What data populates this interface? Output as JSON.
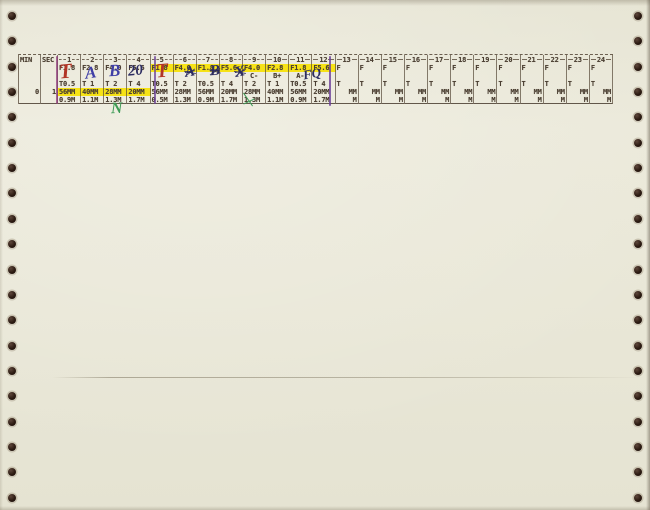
{
  "colors": {
    "paper": "#e9e7d7",
    "ink": "#4a3e31",
    "highlight_yellow": "#f6e216",
    "red_pen": "#b23527",
    "blue_pen": "#3f3fa6",
    "dark_blue_pen": "#2c2c60",
    "green_pen": "#3d9b55",
    "purple_marker": "#6a3f97"
  },
  "table": {
    "min_header": "MIN",
    "sec_header": "SEC",
    "min_value": "0",
    "sec_value": "1",
    "f_highlight_cols": [
      5,
      6,
      7,
      8,
      9,
      10,
      11,
      12
    ],
    "mm_highlight_cols": [
      1,
      2,
      3,
      4
    ],
    "columns": [
      {
        "num": "1",
        "f": "F1.8",
        "grade": "",
        "t": "T0.5",
        "mm": "56MM",
        "m": "0.9M"
      },
      {
        "num": "2",
        "f": "F2.8",
        "grade": "",
        "t": "T 1",
        "mm": "40MM",
        "m": "1.1M"
      },
      {
        "num": "3",
        "f": "F4.0",
        "grade": "",
        "t": "T 2",
        "mm": "28MM",
        "m": "1.3M"
      },
      {
        "num": "4",
        "f": "F5.6",
        "grade": "",
        "t": "T 4",
        "mm": "20MM",
        "m": "1.7M"
      },
      {
        "num": "5",
        "f": "F1.8",
        "grade": "",
        "t": "T0.5",
        "mm": "56MM",
        "m": "0.5M"
      },
      {
        "num": "6",
        "f": "F4.0",
        "grade": "",
        "t": "T 2",
        "mm": "28MM",
        "m": "1.3M"
      },
      {
        "num": "7",
        "f": "F1.8",
        "grade": "",
        "t": "T0.5",
        "mm": "56MM",
        "m": "0.9M"
      },
      {
        "num": "8",
        "f": "F5.6",
        "grade": "",
        "t": "T 4",
        "mm": "20MM",
        "m": "1.7M"
      },
      {
        "num": "9",
        "f": "F4.0",
        "grade": "C-",
        "t": "T 2",
        "mm": "28MM",
        "m": "1.3M"
      },
      {
        "num": "10",
        "f": "F2.8",
        "grade": "B+",
        "t": "T 1",
        "mm": "40MM",
        "m": "1.1M"
      },
      {
        "num": "11",
        "f": "F1.8",
        "grade": "A-",
        "t": "T0.5",
        "mm": "56MM",
        "m": "0.9M"
      },
      {
        "num": "12",
        "f": "F5.6",
        "grade": "",
        "t": "T 4",
        "mm": "20MM",
        "m": "1.7M"
      },
      {
        "num": "13",
        "f": "F",
        "grade": "",
        "t": "T",
        "mm": "MM",
        "m": "M"
      },
      {
        "num": "14",
        "f": "F",
        "grade": "",
        "t": "T",
        "mm": "MM",
        "m": "M"
      },
      {
        "num": "15",
        "f": "F",
        "grade": "",
        "t": "T",
        "mm": "MM",
        "m": "M"
      },
      {
        "num": "16",
        "f": "F",
        "grade": "",
        "t": "T",
        "mm": "MM",
        "m": "M"
      },
      {
        "num": "17",
        "f": "F",
        "grade": "",
        "t": "T",
        "mm": "MM",
        "m": "M"
      },
      {
        "num": "18",
        "f": "F",
        "grade": "",
        "t": "T",
        "mm": "MM",
        "m": "M"
      },
      {
        "num": "19",
        "f": "F",
        "grade": "",
        "t": "T",
        "mm": "MM",
        "m": "M"
      },
      {
        "num": "20",
        "f": "F",
        "grade": "",
        "t": "T",
        "mm": "MM",
        "m": "M"
      },
      {
        "num": "21",
        "f": "F",
        "grade": "",
        "t": "T",
        "mm": "MM",
        "m": "M"
      },
      {
        "num": "22",
        "f": "F",
        "grade": "",
        "t": "T",
        "mm": "MM",
        "m": "M"
      },
      {
        "num": "23",
        "f": "F",
        "grade": "",
        "t": "T",
        "mm": "MM",
        "m": "M"
      },
      {
        "num": "24",
        "f": "F",
        "grade": "",
        "t": "T",
        "mm": "MM",
        "m": "M"
      }
    ]
  },
  "annotations": [
    {
      "id": "hw-grade-col1",
      "text": "T",
      "color": "#b23527"
    },
    {
      "id": "hw-grade-col2",
      "text": "A",
      "color": "#3f3fa6"
    },
    {
      "id": "hw-grade-col3",
      "text": "B",
      "color": "#3f3fa6"
    },
    {
      "id": "hw-grade-col4",
      "text": "20",
      "color": "#2c2c60"
    },
    {
      "id": "hw-grade-col5",
      "text": "T",
      "color": "#b23527"
    },
    {
      "id": "hw-scribble-col6",
      "text": "A",
      "color": "#2c2c60"
    },
    {
      "id": "hw-scribble-col7",
      "text": "B",
      "color": "#2c2c60"
    },
    {
      "id": "hw-scribble-col8",
      "text": "X",
      "color": "#2c2c60"
    },
    {
      "id": "hw-mark-col12",
      "text": "FQ",
      "color": "#2c2c60"
    },
    {
      "id": "hw-letter-n",
      "text": "N",
      "color": "#3d9b55"
    },
    {
      "id": "hw-green-stroke",
      "text": "",
      "color": "#3d9b55"
    }
  ]
}
